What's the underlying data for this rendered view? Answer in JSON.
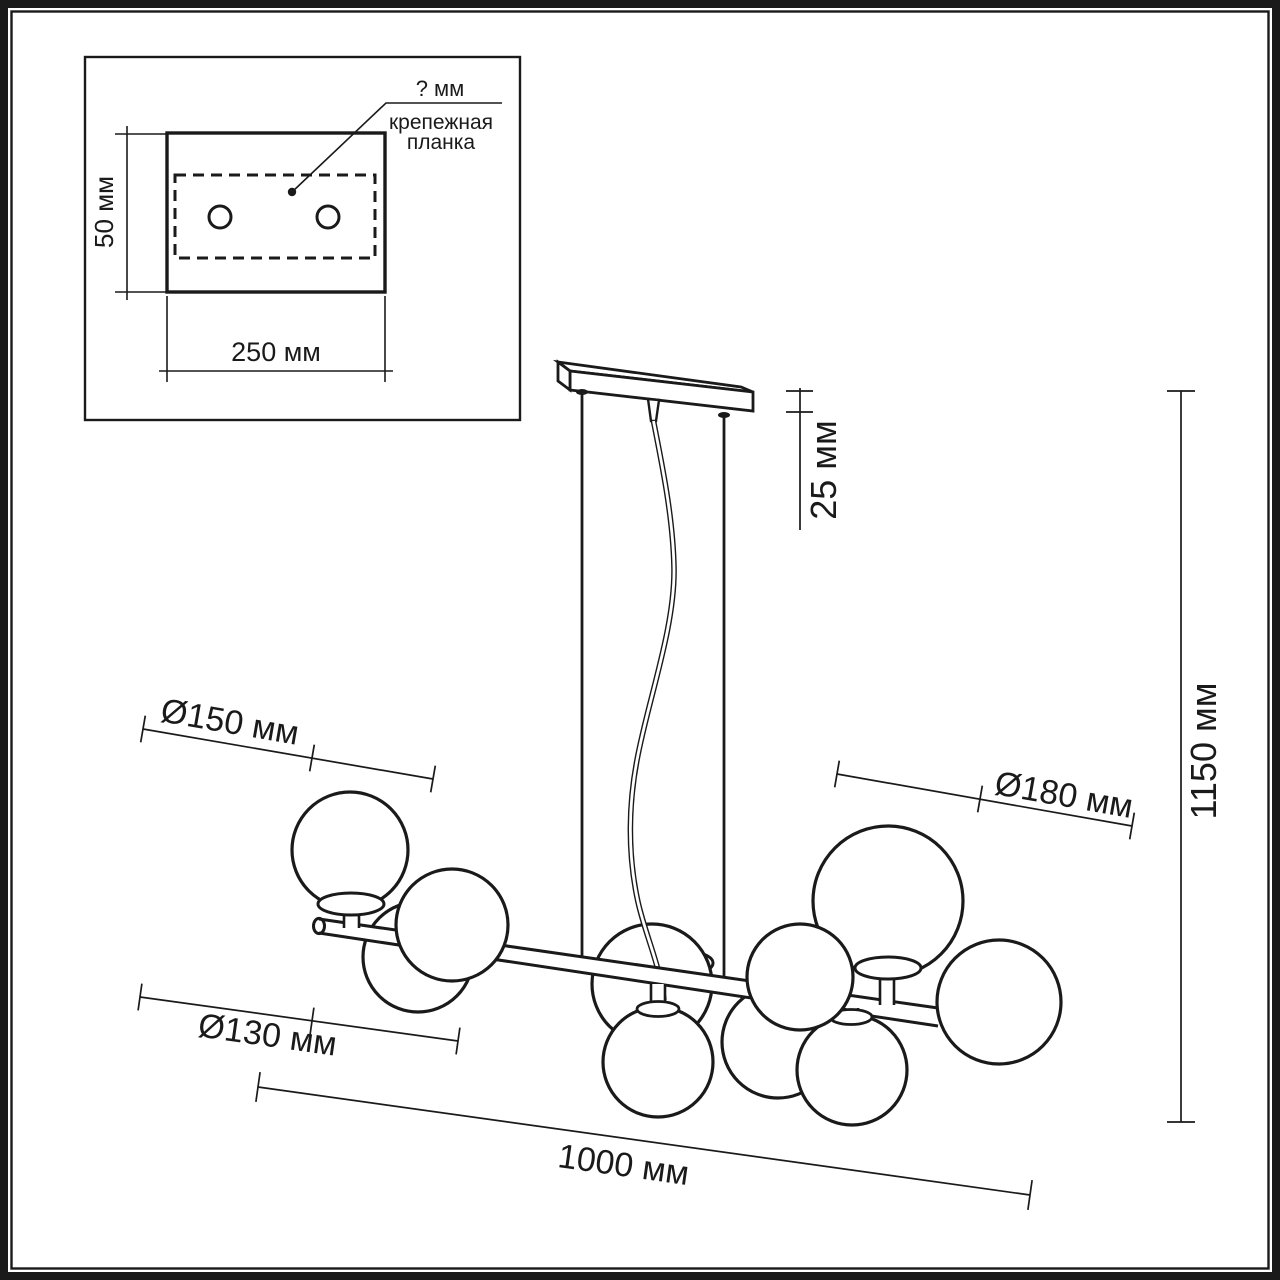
{
  "colors": {
    "ink": "#1a1a1a",
    "paper": "#ffffff"
  },
  "inset": {
    "unknown_dim_label": "? мм",
    "callout_line1": "крепежная",
    "callout_line2": "планка",
    "plate_height_label": "50 мм",
    "plate_width_label": "250 мм"
  },
  "fixture": {
    "canopy_height_label": "25 мм",
    "overall_height_label": "1150 мм",
    "shade_medium_label": "Ø150 мм",
    "shade_large_label": "Ø180 мм",
    "shade_small_label": "Ø130 мм",
    "overall_length_label": "1000 мм"
  }
}
